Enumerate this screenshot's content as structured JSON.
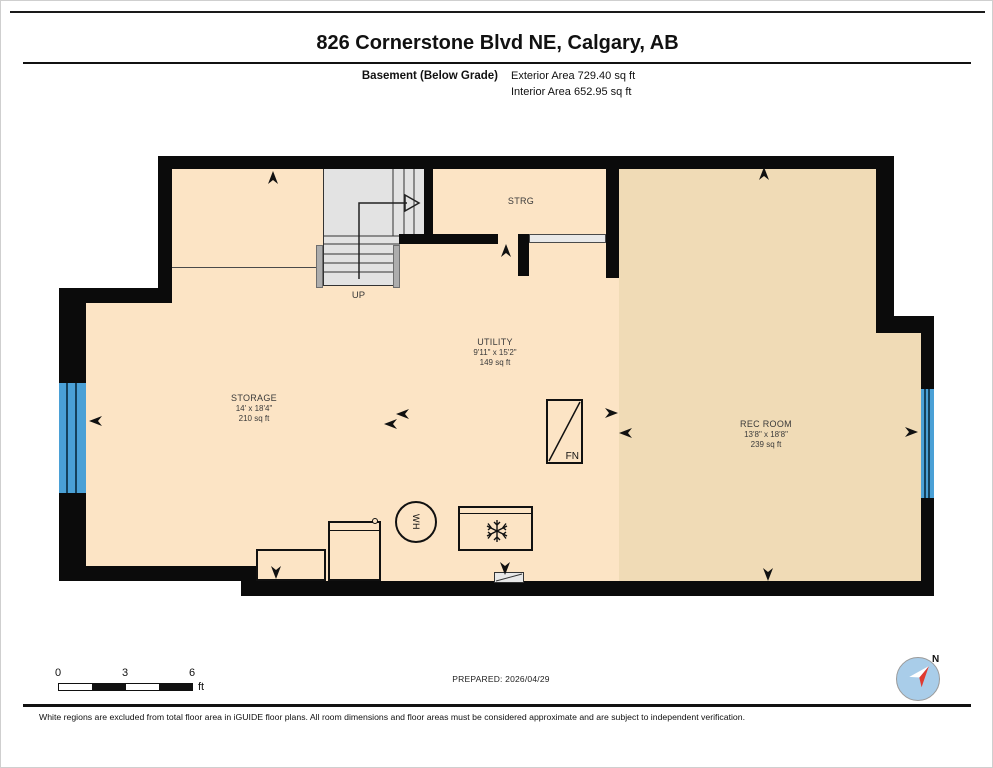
{
  "header": {
    "title": "826 Cornerstone Blvd NE, Calgary, AB",
    "floor_label": "Basement (Below Grade)",
    "exterior_area": "Exterior Area 729.40 sq ft",
    "interior_area": "Interior Area 652.95 sq ft"
  },
  "plan": {
    "rooms": [
      {
        "name": "STRG",
        "dims": "",
        "area": ""
      },
      {
        "name": "UTILITY",
        "dims": "9'11\" x 15'2\"",
        "area": "149 sq ft"
      },
      {
        "name": "STORAGE",
        "dims": "14' x 18'4\"",
        "area": "210 sq ft"
      },
      {
        "name": "REC ROOM",
        "dims": "13'8\" x 18'8\"",
        "area": "239 sq ft"
      }
    ],
    "stairs_label": "UP",
    "furnace_label": "FN",
    "water_heater_label": "WH"
  },
  "footer": {
    "scale": {
      "ticks": [
        "0",
        "3",
        "6"
      ],
      "unit": "ft"
    },
    "prepared": "PREPARED: 2026/04/29",
    "compass_label": "N",
    "disclaimer": "White regions are excluded from total floor area in iGUIDE floor plans. All room dimensions and floor areas must be considered approximate and are subject to independent verification."
  },
  "colors": {
    "floor_interior": "#fce4c5",
    "floor_rec_room": "#f0dbb6",
    "wall": "#0b0b0b",
    "window_exterior": "#4aa0d6",
    "window_interior": "#e9e9e9",
    "stairs": "#e3e3e3",
    "compass_face": "#a9cde9",
    "compass_needle_north": "#e03a30"
  }
}
